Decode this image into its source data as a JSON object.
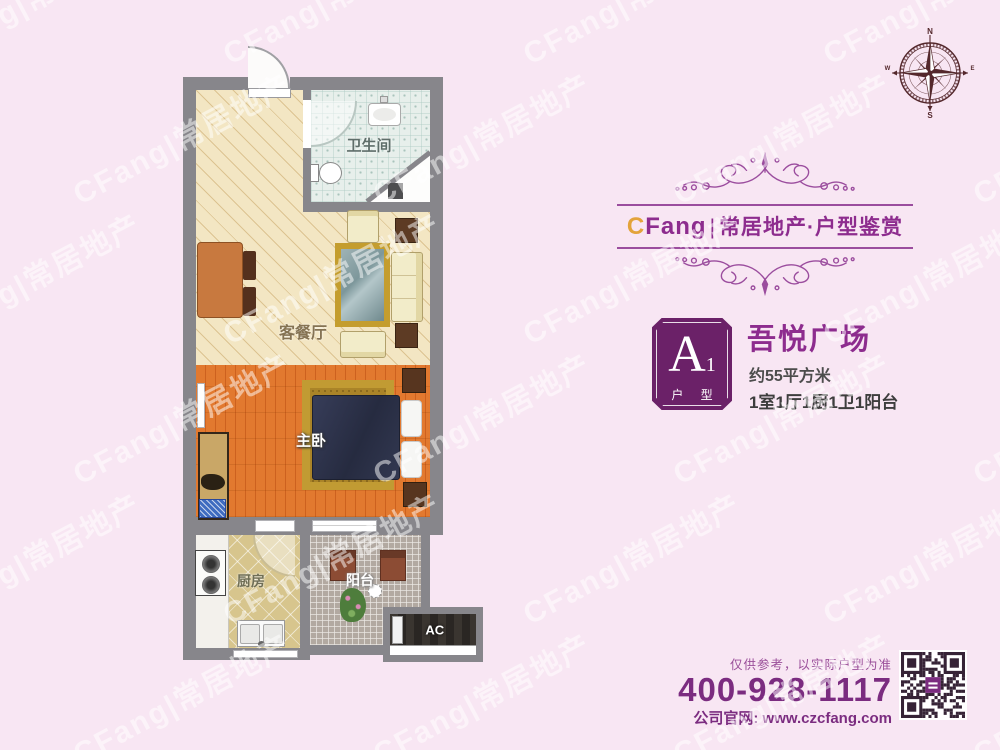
{
  "watermark": {
    "text": "CFang|常居地产"
  },
  "brand": {
    "logo_prefix": "C",
    "logo_suffix": "Fang",
    "separator": "|",
    "tagline": "常居地产·户型鉴赏"
  },
  "unit": {
    "badge_letter": "A",
    "badge_number": "1",
    "badge_caption": "户 型",
    "project_name": "吾悦广场",
    "area_text": "约55平方米",
    "rooms_text": "1室1厅1厨1卫1阳台"
  },
  "floorplan": {
    "living_label": "客餐厅",
    "bedroom_label": "主卧",
    "bathroom_label": "卫生间",
    "kitchen_label": "厨房",
    "balcony_label": "阳台",
    "ac_label": "AC"
  },
  "compass": {
    "north": "N",
    "south": "S",
    "east": "E",
    "west": "W"
  },
  "footer": {
    "disclaimer": "仅供参考，以实际户型为准",
    "phone": "400-928-1117",
    "website": "公司官网: www.czcfang.com"
  },
  "colors": {
    "background_pink": "#f8e6f3",
    "accent_purple": "#8d2c8e",
    "deep_purple": "#7b2c80",
    "badge_purple": "#6b2168",
    "logo_gold": "#e3a33b",
    "wall_gray": "#87868b",
    "compass_maroon": "#54282c"
  }
}
